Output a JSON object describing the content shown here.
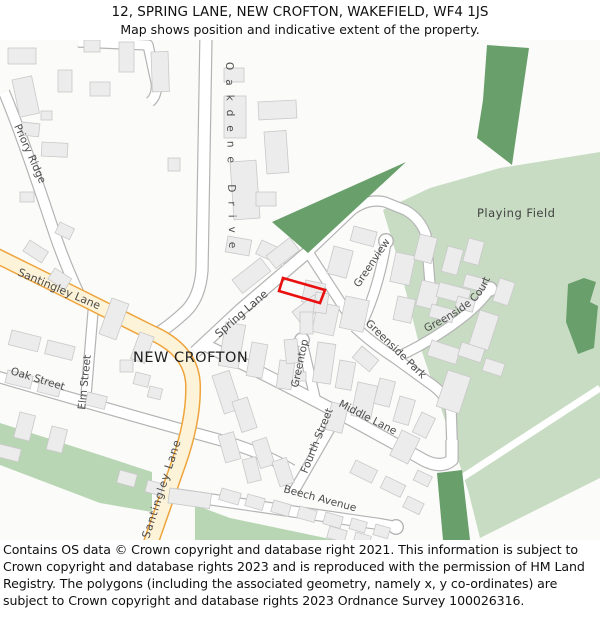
{
  "header": {
    "title": "12, SPRING LANE, NEW CROFTON, WAKEFIELD, WF4 1JS",
    "subtitle": "Map shows position and indicative extent of the property."
  },
  "footer": {
    "copyright": "Contains OS data © Crown copyright and database right 2021. This information is subject to Crown copyright and database rights 2023 and is reproduced with the permission of HM Land Registry. The polygons (including the associated geometry, namely x, y co-ordinates) are subject to Crown copyright and database rights 2023 Ordnance Survey 100026316."
  },
  "map": {
    "place_labels": {
      "new_crofton": "NEW CROFTON",
      "playing_field": "Playing Field"
    },
    "road_labels": {
      "priory_ridge": "Priory Ridge",
      "oakdene_drive": "Oakdene Drive",
      "santingley_lane_upper": "Santingley Lane",
      "santingley_lane_lower": "Santingley Lane",
      "elm_street": "Elm Street",
      "oak_street": "Oak Street",
      "spring_lane": "Spring Lane",
      "greenview": "Greenview",
      "greentop": "Greentop",
      "greenside_court": "Greenside Court",
      "greenside_park": "Greenside Park",
      "middle_lane": "Middle Lane",
      "fourth_street": "Fourth Street",
      "beech_avenue": "Beech Avenue"
    },
    "colors": {
      "background": "#fbfbfa",
      "road_fill": "#ffffff",
      "road_casing": "#b4b4b4",
      "primary_road_fill": "#fdf3d8",
      "primary_road_casing": "#eea43c",
      "building_fill": "#ececec",
      "building_stroke": "#c9c9c9",
      "green_light": "#c8dcc3",
      "green_band": "#b9d6b4",
      "green_dark": "#699f6b",
      "plot_outline": "#ea1010"
    }
  }
}
